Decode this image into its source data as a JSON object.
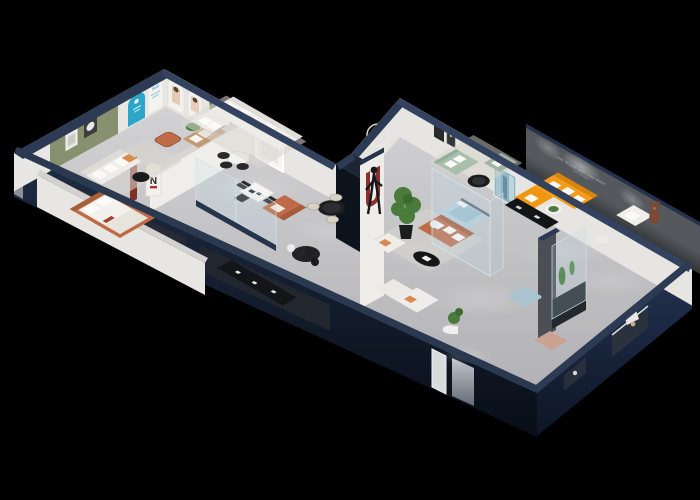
{
  "scene": {
    "description": "3D isometric cutaway dollhouse render of a furniture showroom apartment floating on a black background",
    "view": "isometric cutaway floor plan",
    "background": "#000000",
    "palette": {
      "wallTop": "#2c3a54",
      "wallTopLight": "#33425e",
      "wallInner": "#e9e7e3",
      "floor": "#c9c9cc",
      "greenWall": "#87906f",
      "cyan": "#2ba6c9",
      "terracotta": "#bf6b47",
      "tan": "#c49a74",
      "orange": "#f59d1b",
      "sage": "#a9bfab",
      "sageDark": "#9fb5a2",
      "lightBlue": "#aac4cf",
      "blueBed": "#b7cedb",
      "mediaWall": "#55595d",
      "red": "#8c2f2c",
      "darkRed": "#7e2f26",
      "plant": "#4a7a3c",
      "black": "#141518",
      "teddy": "#7b4a32",
      "mirror": "#d8dadc",
      "rug": "#dbd7cf"
    },
    "feature_wall": {
      "slogan_line1": "LIVE IN THE WAY YOU WANT",
      "slogan_line2": "MY HOME"
    },
    "gallery": {
      "logo": "N",
      "arch_label": "888"
    },
    "rooms": [
      {
        "id": "gallery-lounge",
        "label": "Arch gallery lounge",
        "furniture": [
          "green accent wall with two framed artworks",
          "cyan display arch",
          "white arch with 888 sign",
          "poster arches with model photo",
          "green door",
          "red arch niche",
          "terracotta leather ottoman",
          "tan loveseat with white pillows",
          "white sofa with orange pillow",
          "white round table with black chairs",
          "potted plant"
        ]
      },
      {
        "id": "bedroom-display",
        "label": "Bedroom display",
        "furniture": [
          "terracotta platform bed with white bedding",
          "black media console",
          "white chair",
          "small black table"
        ]
      },
      {
        "id": "living-dining",
        "label": "Living and dining display",
        "furniture": [
          "white L-shaped sectional sofa with pillows",
          "white dining table",
          "dark dining chairs",
          "terracotta loveseat",
          "black round dining table with cream chairs",
          "standing figure sculpture",
          "circle wall decor",
          "large white wall frame",
          "glass partition with dark base rail"
        ]
      },
      {
        "id": "corridor",
        "label": "Corridor",
        "furniture": [
          "dark stair shaft",
          "white column with red arch decor",
          "arch column with N logo",
          "dark red plank",
          "dark oval rug",
          "mirror panel",
          "lit doorway"
        ]
      },
      {
        "id": "lounge-corner",
        "label": "Lounge corner",
        "furniture": [
          "tall potted plant in black pot",
          "terracotta three-seat sofa with white pillows",
          "white armchair with orange pillow",
          "black oval coffee table",
          "glass bedroom display with light blue bed"
        ]
      },
      {
        "id": "main-showroom",
        "label": "Main showroom",
        "furniture": [
          "sage green sofa set",
          "black round coffee table",
          "blue abstract artwork",
          "black wall frames",
          "dark feature wall with slogan and spotlights",
          "orange sectional sofa with white pillows",
          "black media console",
          "round side table with plant",
          "white armchair",
          "teddy bear mascot",
          "white side tables",
          "light blue ottoman",
          "gray column",
          "glass plant display case",
          "white corner sofas",
          "pink lounge chair",
          "window openings with white table glimpse"
        ]
      }
    ]
  }
}
